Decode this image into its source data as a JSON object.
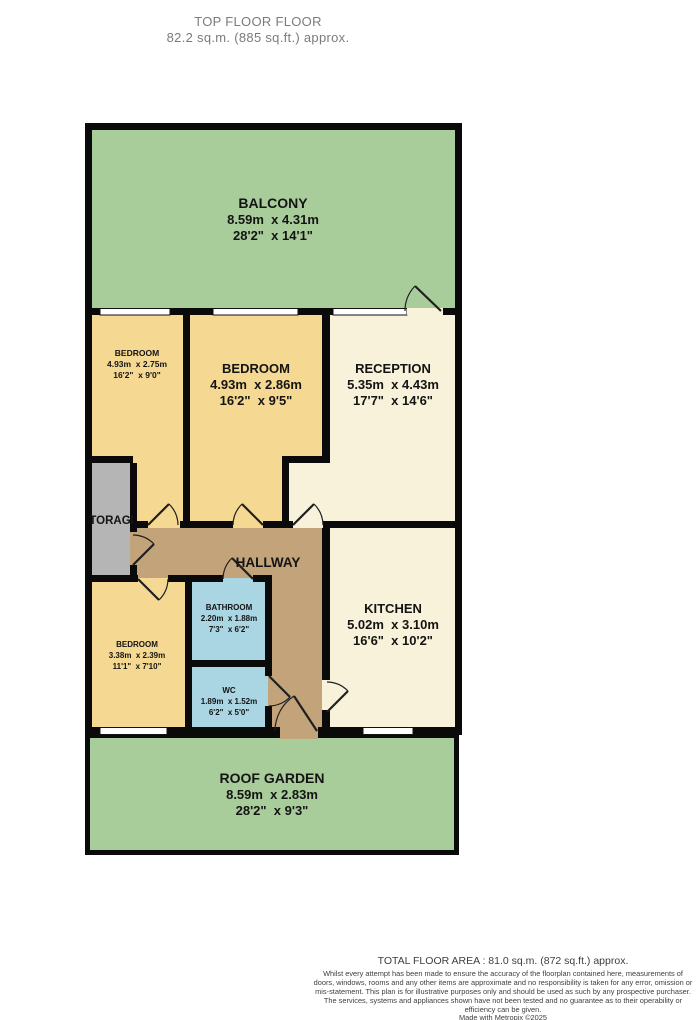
{
  "header": {
    "title": "TOP FLOOR FLOOR",
    "subtitle": "82.2 sq.m. (885 sq.ft.) approx."
  },
  "rooms": {
    "balcony": {
      "name": "BALCONY",
      "metric": "8.59m  x 4.31m",
      "imperial": "28'2\"  x 14'1\""
    },
    "bedroom1": {
      "name": "BEDROOM",
      "metric": "4.93m  x 2.75m",
      "imperial": "16'2\"  x 9'0\""
    },
    "bedroom2": {
      "name": "BEDROOM",
      "metric": "4.93m  x 2.86m",
      "imperial": "16'2\"  x 9'5\""
    },
    "reception": {
      "name": "RECEPTION",
      "metric": "5.35m  x 4.43m",
      "imperial": "17'7\"  x 14'6\""
    },
    "storage": {
      "name": "STORAGE"
    },
    "hallway": {
      "name": "HALLWAY"
    },
    "bathroom": {
      "name": "BATHROOM",
      "metric": "2.20m  x 1.88m",
      "imperial": "7'3\"  x 6'2\""
    },
    "bedroom3": {
      "name": "BEDROOM",
      "metric": "3.38m  x 2.39m",
      "imperial": "11'1\"  x 7'10\""
    },
    "wc": {
      "name": "WC",
      "metric": "1.89m  x 1.52m",
      "imperial": "6'2\"  x 5'0\""
    },
    "kitchen": {
      "name": "KITCHEN",
      "metric": "5.02m  x 3.10m",
      "imperial": "16'6\"  x 10'2\""
    },
    "roof_garden": {
      "name": "ROOF GARDEN",
      "metric": "8.59m  x 2.83m",
      "imperial": "28'2\"  x 9'3\""
    }
  },
  "footer": {
    "total_area": "TOTAL FLOOR AREA : 81.0 sq.m. (872 sq.ft.) approx.",
    "disclaimer": "Whilst every attempt has been made to ensure the accuracy of the floorplan contained here, measurements of doors, windows, rooms and any other items are approximate and no responsibility is taken for any error, omission or mis-statement. This plan is for illustrative purposes only and should be used as such by any prospective purchaser. The services, systems and appliances shown have not been tested and no guarantee as to their operability or efficiency can be given.",
    "credit": "Made with Metropix ©2025"
  },
  "colors": {
    "outdoor_green": "#a9cc9b",
    "bedroom_yellow": "#f5d992",
    "living_cream": "#f8f2da",
    "hallway_tan": "#c2a37a",
    "wet_blue": "#aad5e2",
    "storage_gray": "#b5b5b5",
    "wall_black": "#0a0a0a",
    "title_gray": "#7b7b7b"
  }
}
